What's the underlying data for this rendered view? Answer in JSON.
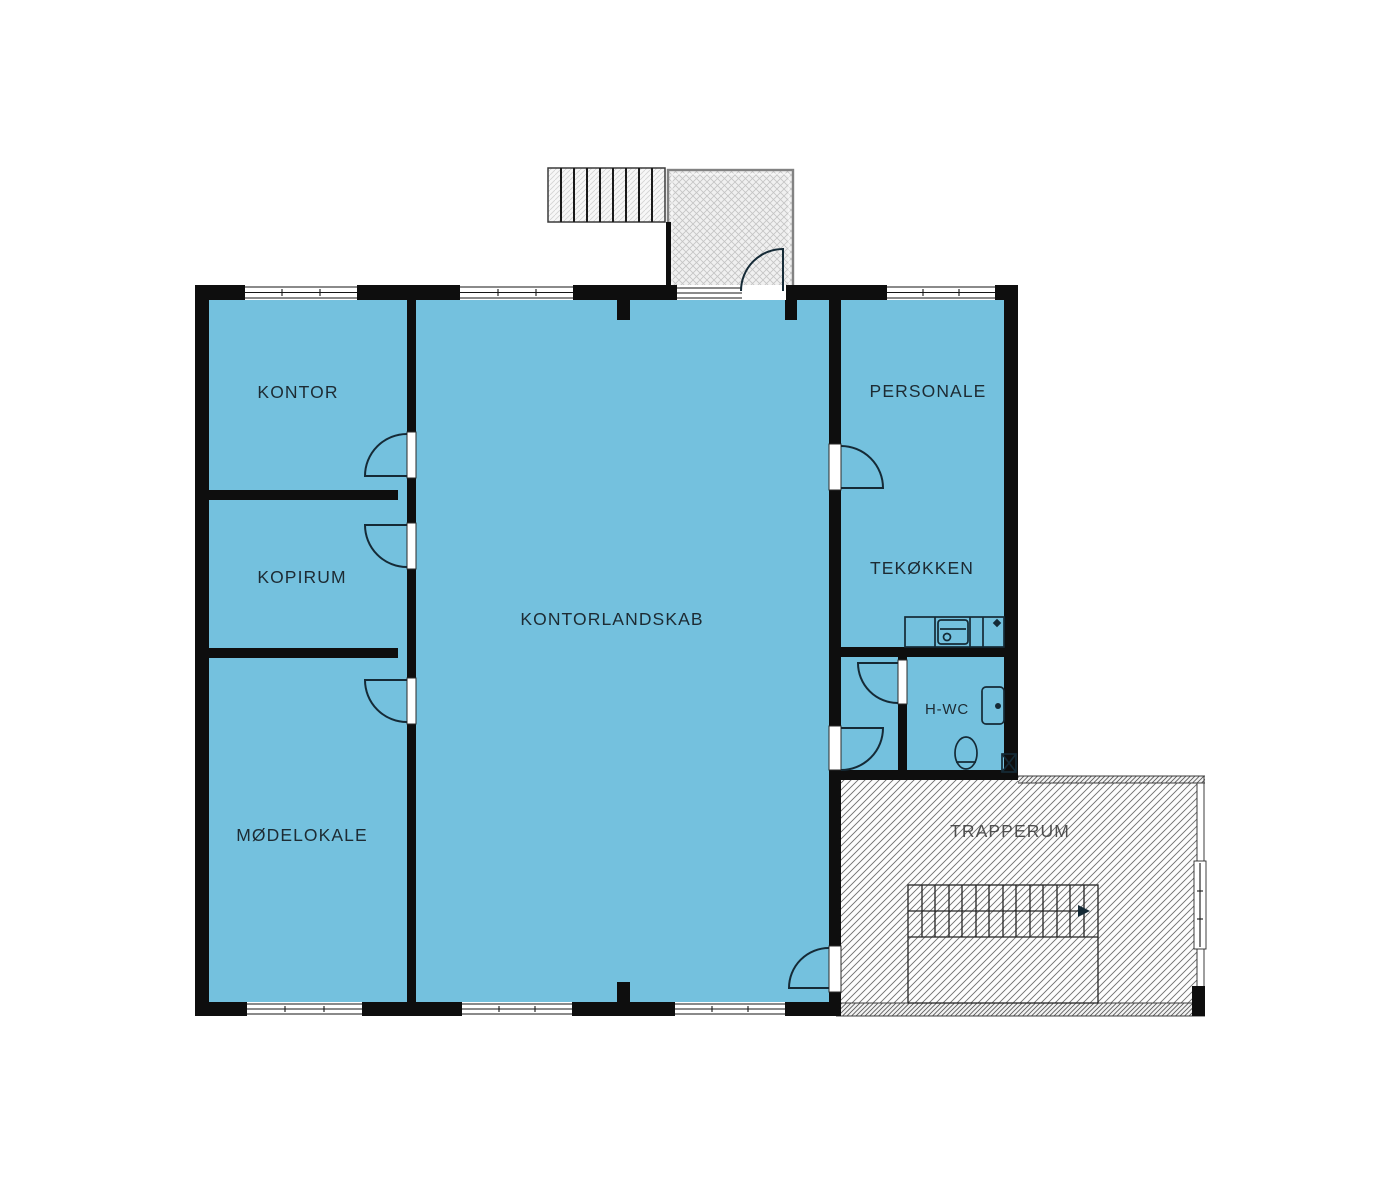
{
  "title": "Office floor plan",
  "rooms": {
    "kontor": "KONTOR",
    "kopirum": "KOPIRUM",
    "moedelokale": "MØDELOKALE",
    "kontorlandskab": "KONTORLANDSKAB",
    "personale": "PERSONALE",
    "tekoekken": "TEKØKKEN",
    "hwc": "H-WC",
    "trapperum": "TRAPPERUM"
  },
  "icons": {
    "kitchen_sink": "sink-icon",
    "faucet": "faucet-icon",
    "washbasin": "washbasin-icon",
    "toilet": "toilet-icon",
    "floor_drain": "floor-drain-icon",
    "stair_direction": "stair-arrow-icon"
  },
  "colors": {
    "room_fill": "#74C1DE",
    "wall": "#0e0e0e",
    "door_line": "#152a36",
    "hatch_line": "#6e6e6e",
    "fine_hatch_line": "#555555",
    "porch_hatch_line": "#c4c4c4",
    "label_text": "#1d2b33",
    "background": "#ffffff"
  }
}
